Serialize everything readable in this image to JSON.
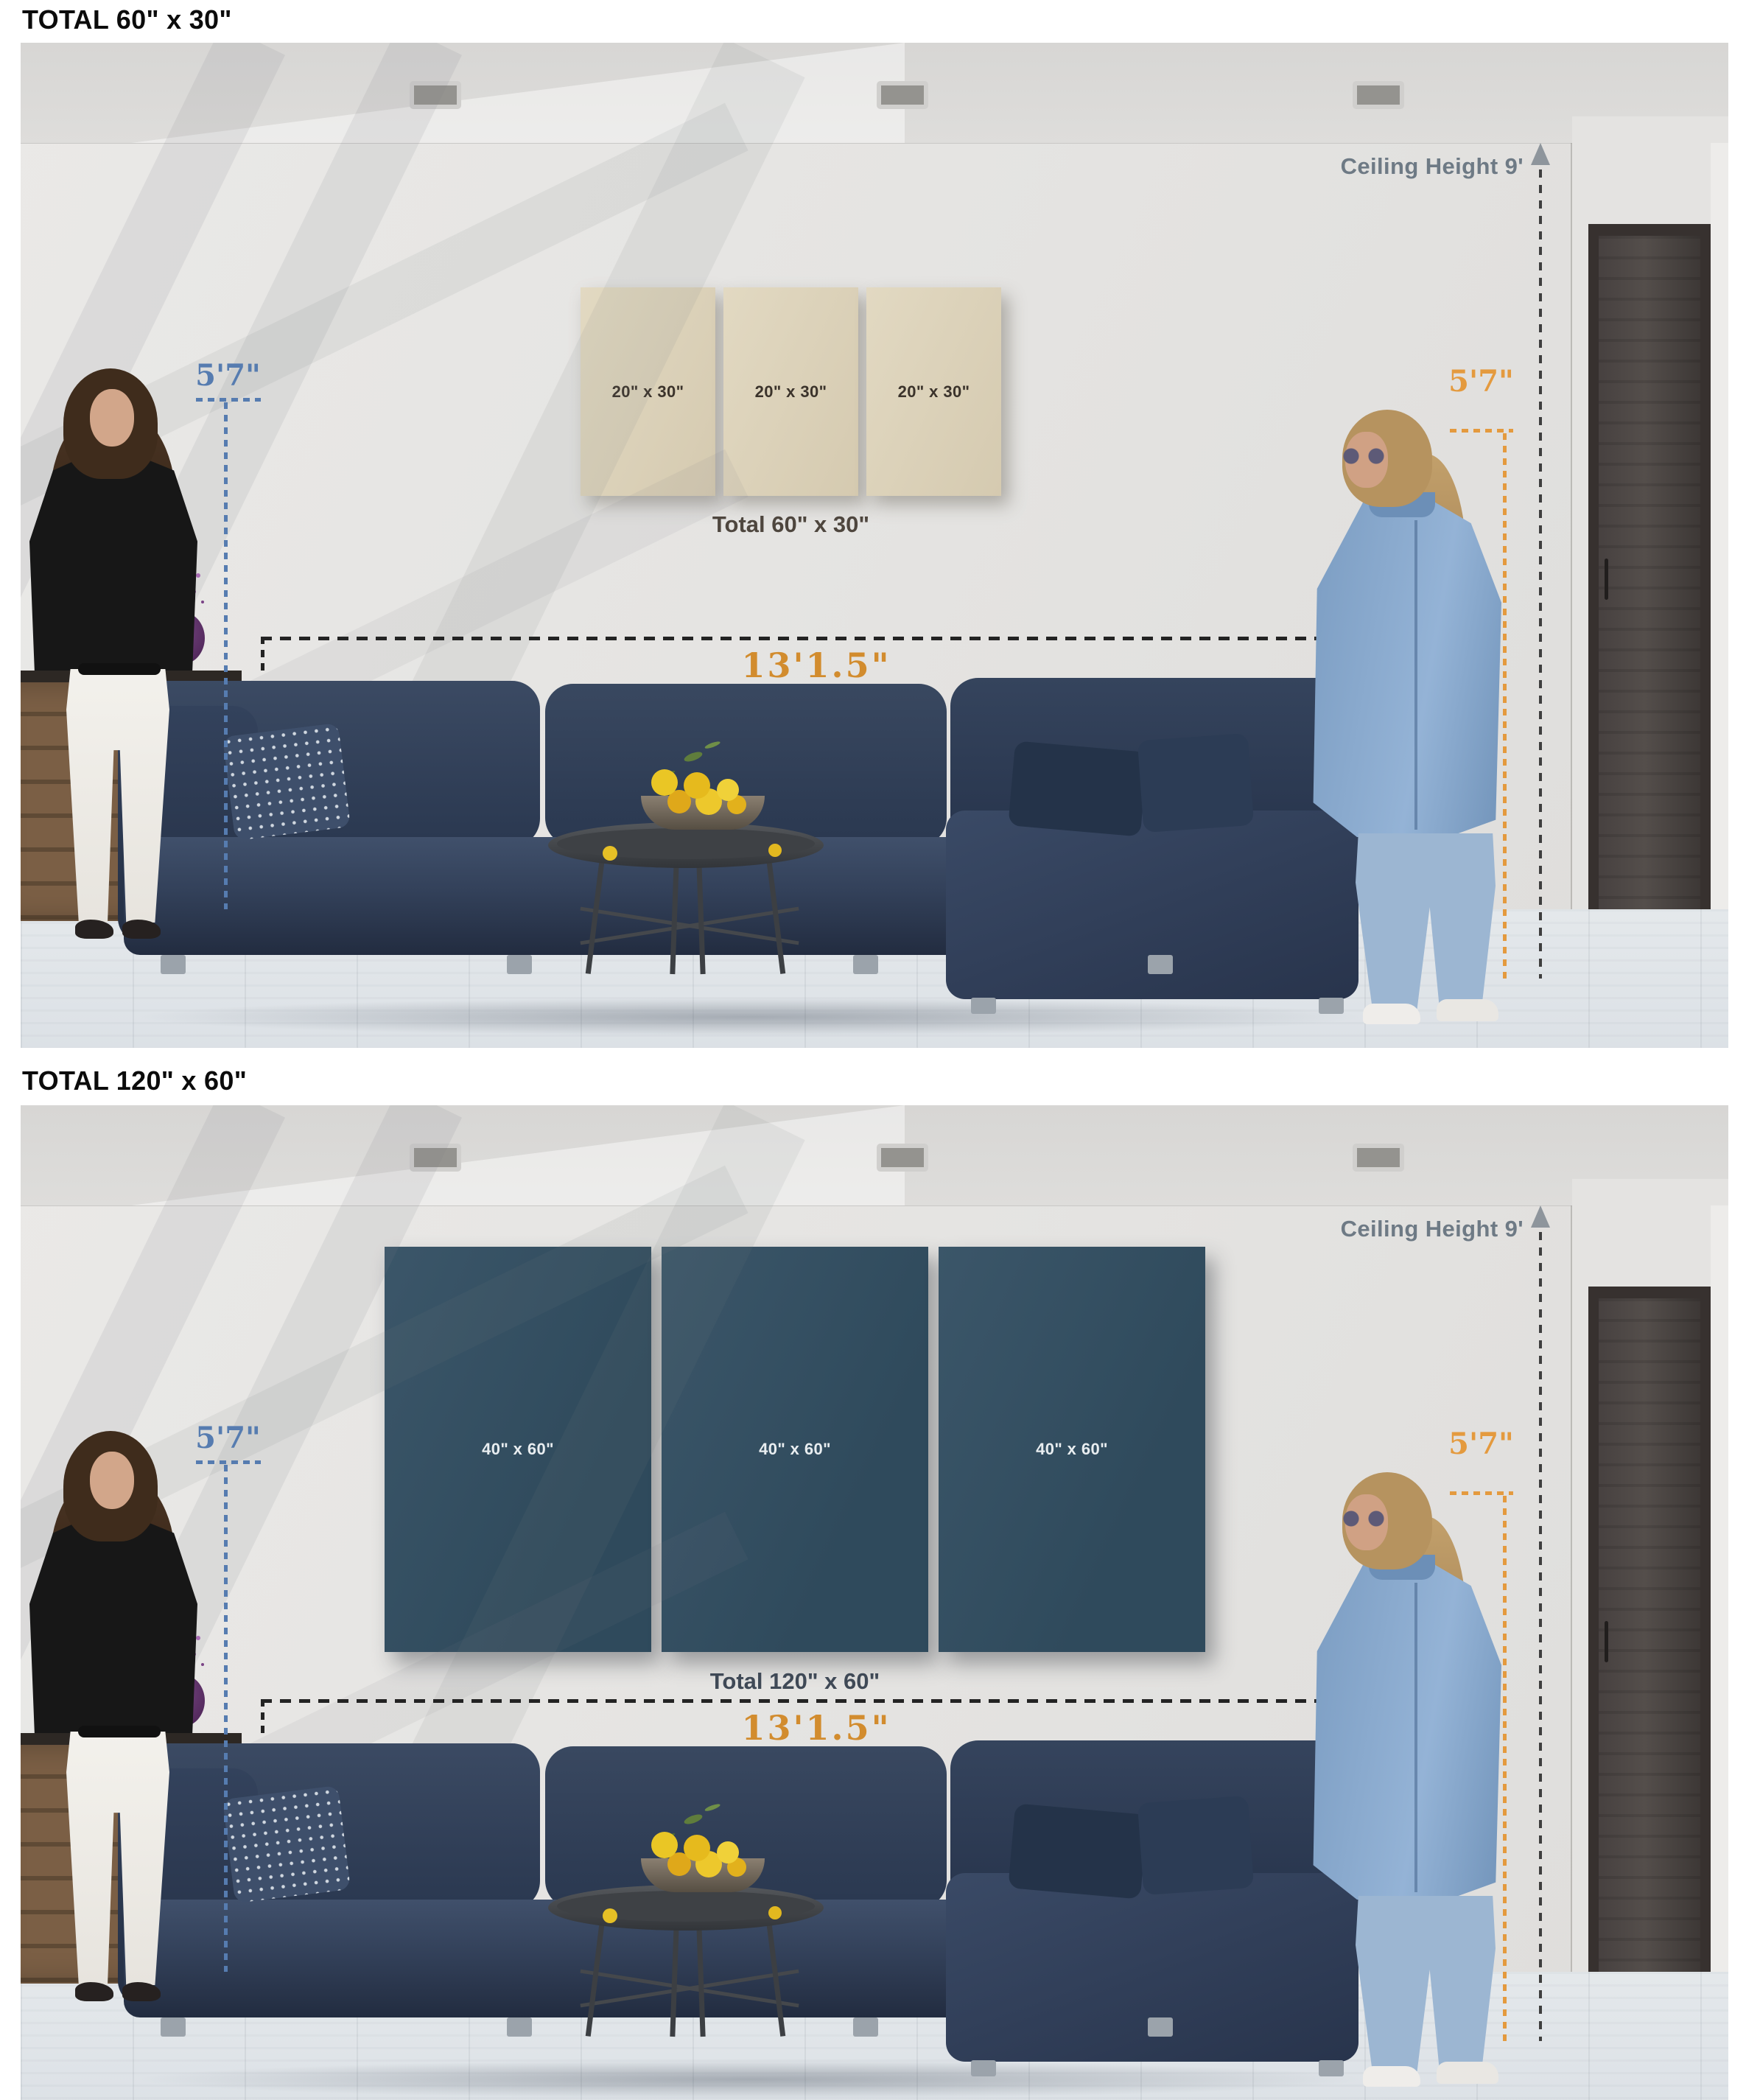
{
  "sections": [
    {
      "title": "TOTAL 60\" x 30\"",
      "panels": [
        {
          "label": "20\" x 30\""
        },
        {
          "label": "20\" x 30\""
        },
        {
          "label": "20\" x 30\""
        }
      ],
      "total_label": "Total 60\" x 30\"",
      "ceiling_label": "Ceiling Height 9'",
      "left_height_label": "5'7\"",
      "right_height_label": "5'7\"",
      "sofa_width_label": "13'1.5\""
    },
    {
      "title": "TOTAL 120\" x 60\"",
      "panels": [
        {
          "label": "40\" x 60\""
        },
        {
          "label": "40\" x 60\""
        },
        {
          "label": "40\" x 60\""
        }
      ],
      "total_label": "Total 120\" x 60\"",
      "ceiling_label": "Ceiling Height 9'",
      "left_height_label": "5'7\"",
      "right_height_label": "5'7\"",
      "sofa_width_label": "13'1.5\""
    }
  ],
  "colors": {
    "panel_beige": "#dcd3ba",
    "panel_beige_text": "#3b332b",
    "panel_dark": "#345062",
    "panel_dark_text": "#e8edf0",
    "annotation_blue": "#567cb0",
    "annotation_orange": "#e49a3e",
    "ceiling_text_gray": "#6e7a85",
    "measure_line_black": "#232323",
    "sofa_width_text_orange": "#d28c2e"
  },
  "icons": {
    "ceiling_arrow": "triangle-up"
  }
}
